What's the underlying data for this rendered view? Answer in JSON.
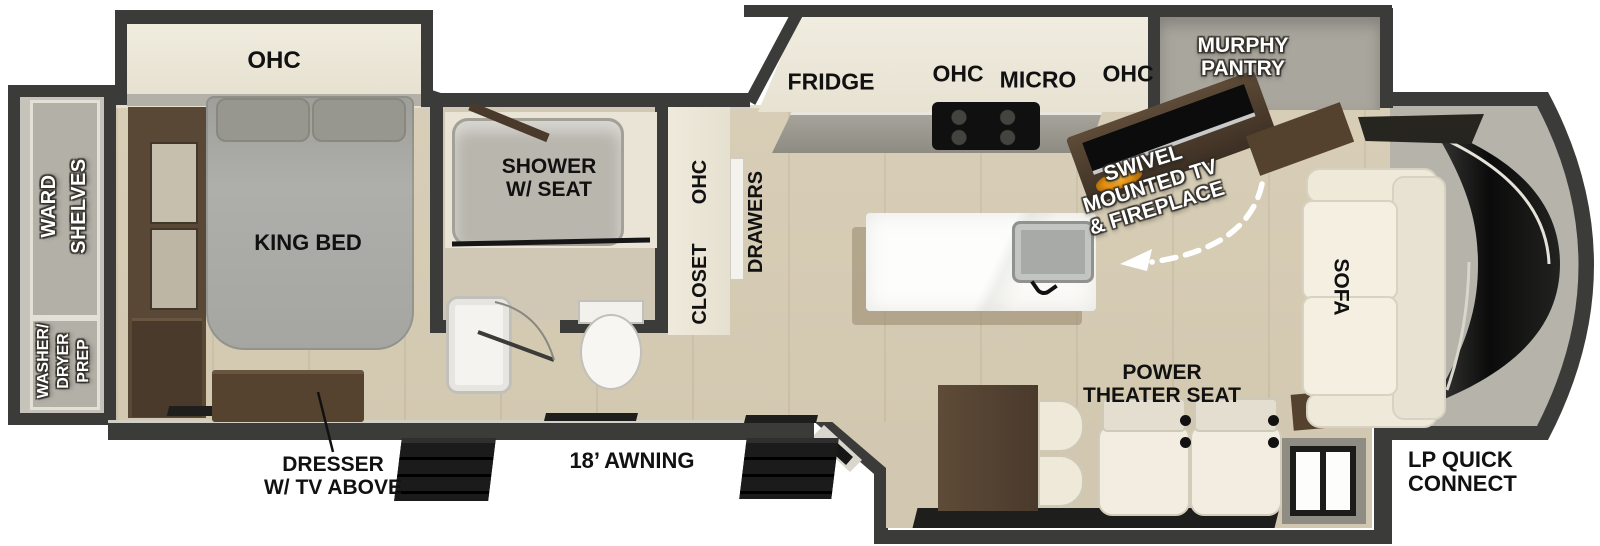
{
  "plan": {
    "labels": {
      "bedroom_ohc": "OHC",
      "ward_shelves": "WARD\nSHELVES",
      "washer_dryer_prep": "WASHER/\nDRYER\nPREP",
      "king_bed": "KING BED",
      "dresser_tv": "DRESSER\nW/ TV ABOVE",
      "shower_seat": "SHOWER\nW/ SEAT",
      "closet_ohc": "OHC",
      "closet": "CLOSET",
      "drawers": "DRAWERS",
      "fridge": "FRIDGE",
      "kitchen_ohc_left": "OHC",
      "micro": "MICRO",
      "kitchen_ohc_right": "OHC",
      "murphy_pantry": "MURPHY\nPANTRY",
      "swivel_tv_fireplace": "SWIVEL\nMOUNTED TV\n& FIREPLACE",
      "sofa": "SOFA",
      "power_theater_seat": "POWER\nTHEATER SEAT",
      "awning": "18’ AWNING",
      "lp_quick_connect": "LP QUICK\nCONNECT"
    },
    "colors": {
      "wall": "#3b3b39",
      "floor": "#d8ceb7",
      "floor_dark": "#d2c8b1",
      "cream": "#ece7d8",
      "slide_gray": "#b3b0a7",
      "room_gray": "#a9a69d",
      "brown": "#5a4836",
      "brown_dark": "#42342a",
      "bed_gray": "#a9a9a5",
      "white": "#f7f5f0",
      "black": "#141414",
      "fire_orange": "#e8920f",
      "label_black": "#111111",
      "label_white": "#ffffff"
    }
  }
}
